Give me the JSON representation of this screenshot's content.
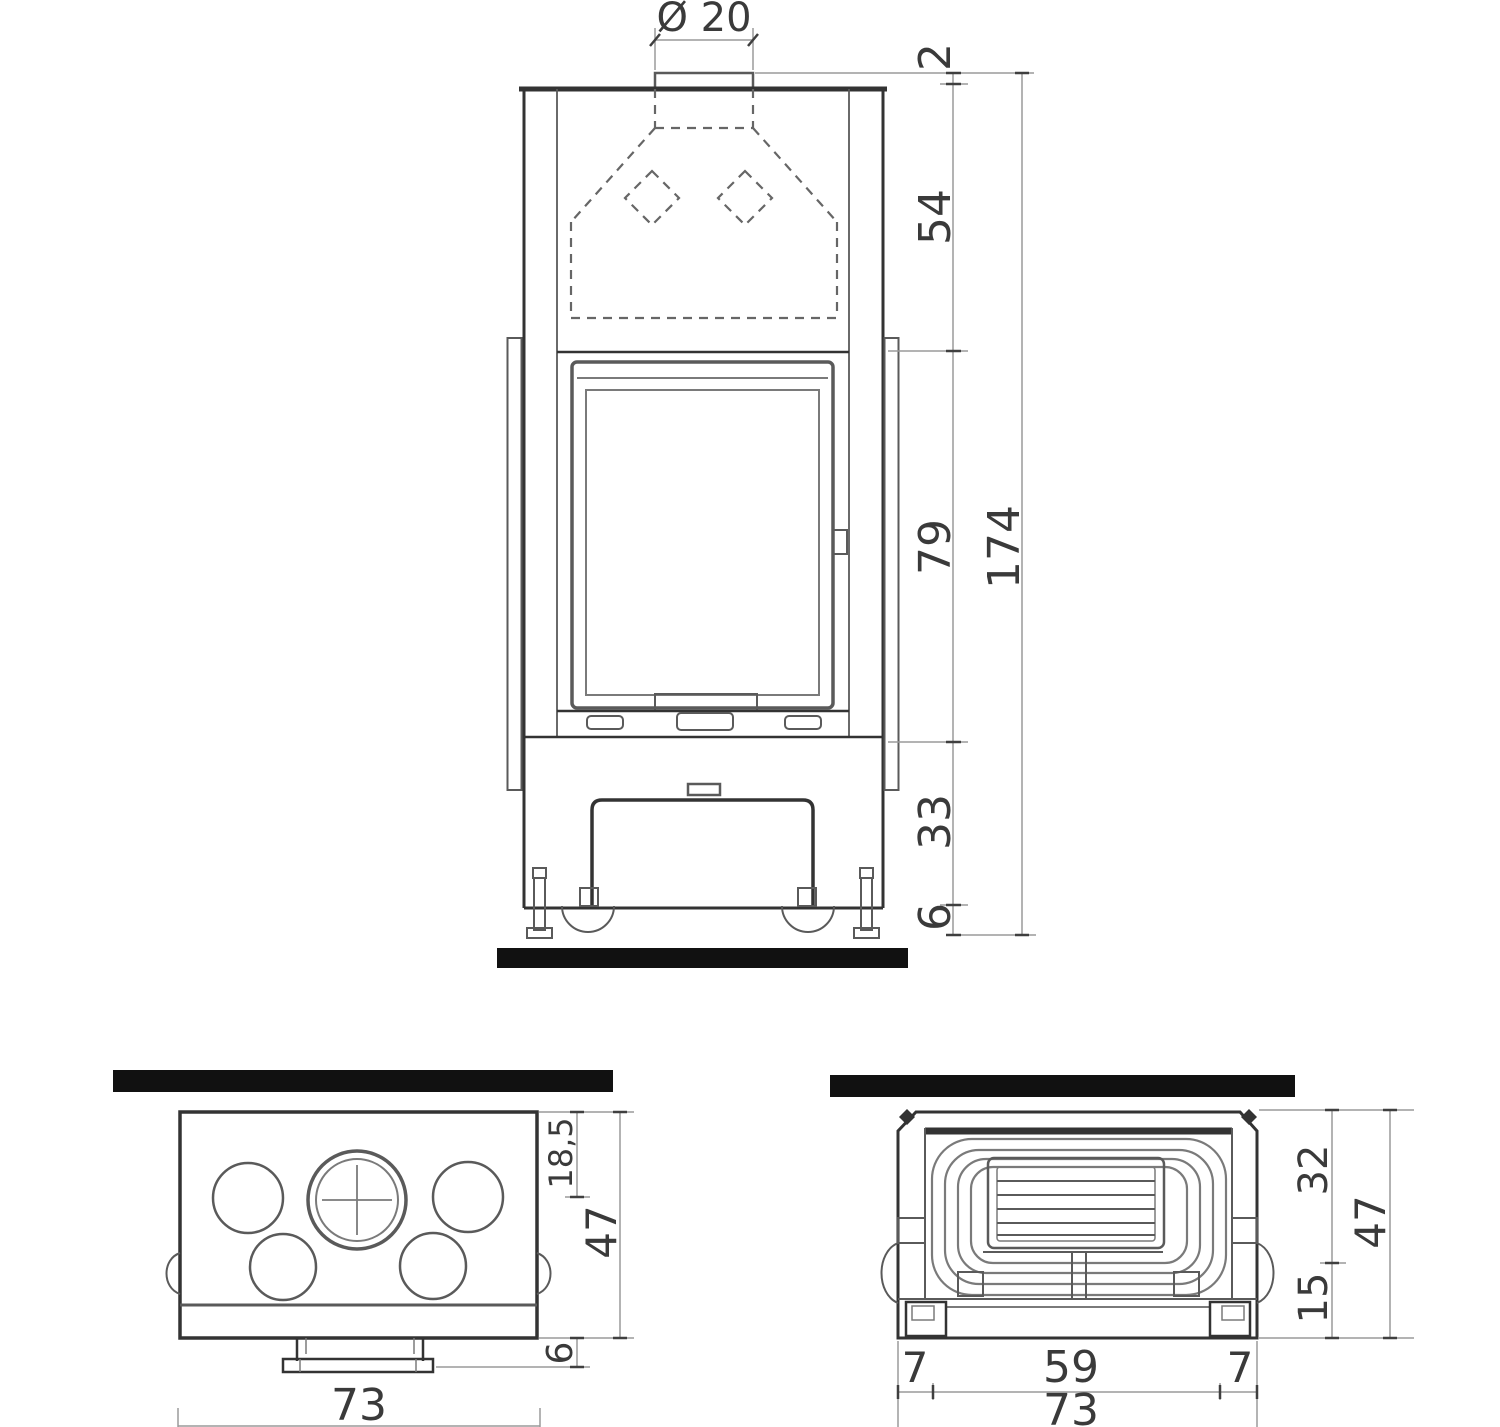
{
  "front_view": {
    "flue_diameter_label": "Ø 20",
    "dims": {
      "collar_above_top": "2",
      "hood_section_height": "54",
      "door_section_height": "79",
      "base_section_height": "33",
      "feet_height": "6",
      "total_height": "174"
    }
  },
  "top_view": {
    "dims": {
      "flue_center_from_back": "18,5",
      "depth": "47",
      "handle_projection": "6",
      "width": "73"
    }
  },
  "rear_view": {
    "dims": {
      "upper_section_height": "32",
      "total_height": "47",
      "lower_section_height": "15",
      "left_margin": "7",
      "inner_width": "59",
      "right_margin": "7",
      "width": "73"
    }
  },
  "colors": {
    "wall_bar": "#111111",
    "line_dark": "#333333",
    "line_mid": "#5a5a5a",
    "dim_line": "#9a9a9a",
    "label_text": "#3a3a3a",
    "background": "#ffffff"
  }
}
